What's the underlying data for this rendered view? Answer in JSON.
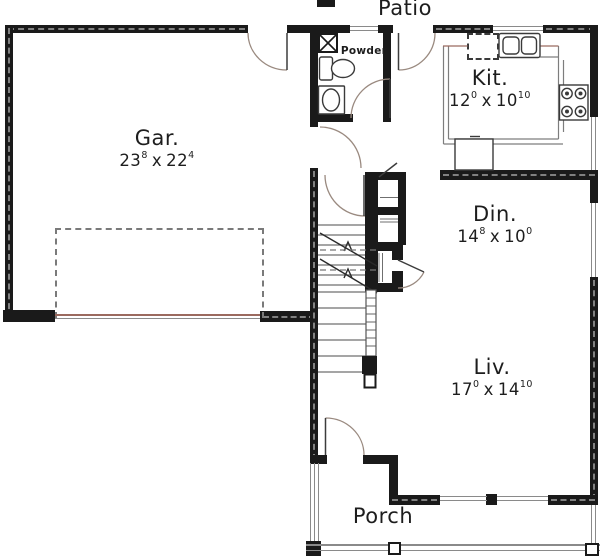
{
  "plan": {
    "colors": {
      "background": "#ffffff",
      "wall": "#1a1a1a",
      "thin_line": "#8a8a8a",
      "accent_line": "#9b6a5f",
      "text": "#1d1d1d"
    },
    "dim_separator": "x",
    "areas": {
      "patio": "Patio",
      "porch": "Porch",
      "powder": "Powder"
    },
    "rooms": {
      "garage": {
        "abbr": "Gar.",
        "dim": {
          "w": "23",
          "wi": "8",
          "l": "22",
          "li": "4"
        }
      },
      "kitchen": {
        "abbr": "Kit.",
        "dim": {
          "w": "12",
          "wi": "0",
          "l": "10",
          "li": "10"
        }
      },
      "dining": {
        "abbr": "Din.",
        "dim": {
          "w": "14",
          "wi": "8",
          "l": "10",
          "li": "0"
        }
      },
      "living": {
        "abbr": "Liv.",
        "dim": {
          "w": "17",
          "wi": "0",
          "l": "14",
          "li": "10"
        }
      }
    },
    "fixtures": [
      "toilet",
      "pedestal-sink",
      "kitchen-sink",
      "dishwasher",
      "range",
      "refrigerator",
      "stairs",
      "garage-door",
      "porch-posts"
    ]
  }
}
